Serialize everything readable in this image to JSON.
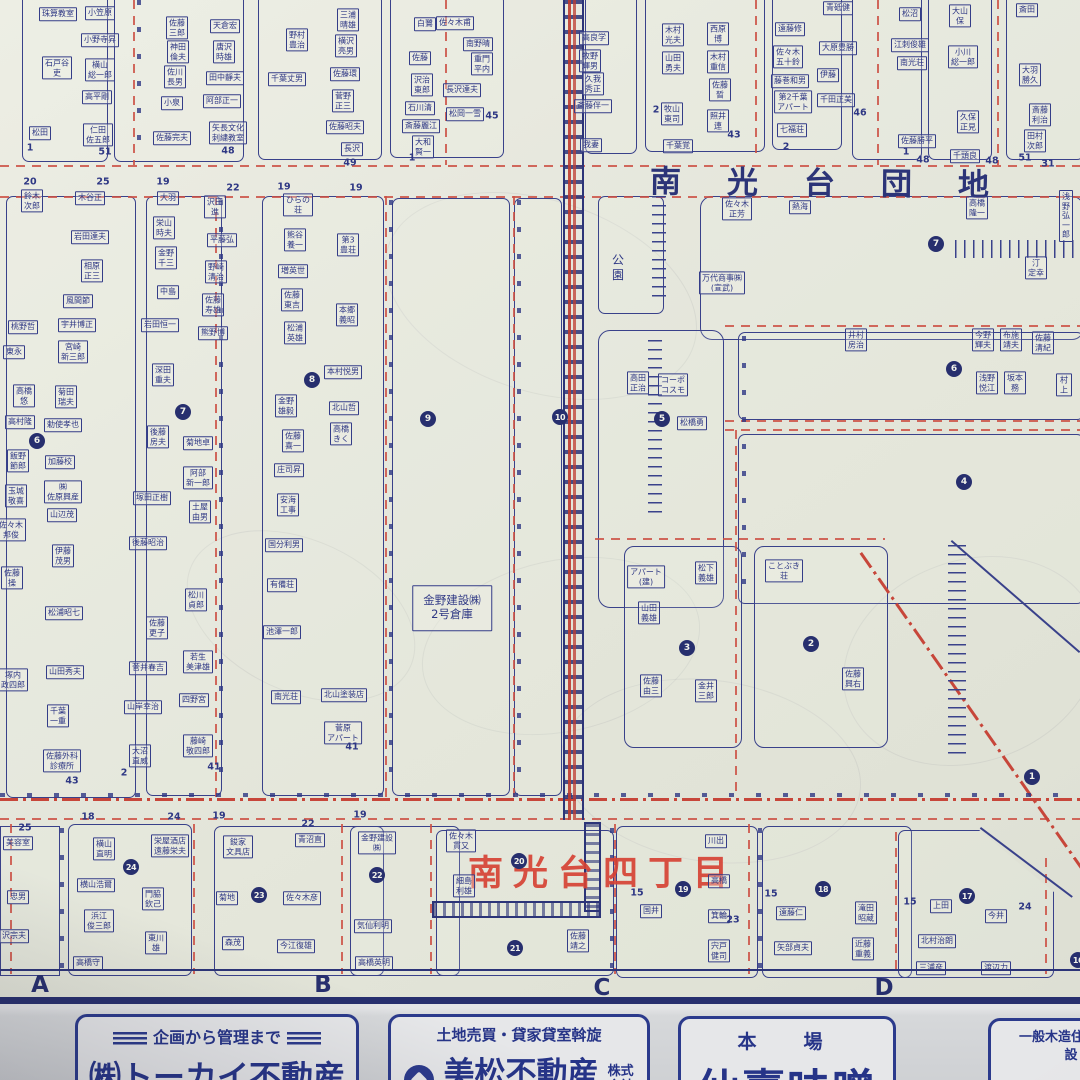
{
  "map": {
    "district_title": "南光台団地",
    "chome_label_red": "南光台四丁目",
    "warehouse_note": "金野建設㈱\n2号倉庫",
    "park_label": "公\n園",
    "grid_letters": [
      {
        "t": "A",
        "x": 40,
        "y": 985
      },
      {
        "t": "B",
        "x": 323,
        "y": 985
      },
      {
        "t": "C",
        "x": 602,
        "y": 988
      },
      {
        "t": "D",
        "x": 884,
        "y": 988
      }
    ],
    "circled_numbers": [
      {
        "n": "1",
        "x": 1032,
        "y": 777
      },
      {
        "n": "2",
        "x": 811,
        "y": 644
      },
      {
        "n": "3",
        "x": 687,
        "y": 648
      },
      {
        "n": "4",
        "x": 964,
        "y": 482
      },
      {
        "n": "5",
        "x": 662,
        "y": 419
      },
      {
        "n": "6",
        "x": 954,
        "y": 369
      },
      {
        "n": "6",
        "x": 37,
        "y": 441
      },
      {
        "n": "7",
        "x": 936,
        "y": 244
      },
      {
        "n": "7",
        "x": 183,
        "y": 412
      },
      {
        "n": "8",
        "x": 312,
        "y": 380
      },
      {
        "n": "9",
        "x": 428,
        "y": 419
      },
      {
        "n": "10",
        "x": 560,
        "y": 417
      },
      {
        "n": "16",
        "x": 1078,
        "y": 960
      },
      {
        "n": "17",
        "x": 967,
        "y": 896
      },
      {
        "n": "18",
        "x": 823,
        "y": 889
      },
      {
        "n": "19",
        "x": 683,
        "y": 889
      },
      {
        "n": "20",
        "x": 519,
        "y": 861
      },
      {
        "n": "21",
        "x": 515,
        "y": 948
      },
      {
        "n": "22",
        "x": 377,
        "y": 875
      },
      {
        "n": "23",
        "x": 259,
        "y": 895
      },
      {
        "n": "24",
        "x": 131,
        "y": 867
      }
    ],
    "lot_numbers": [
      {
        "t": "1",
        "x": 30,
        "y": 148
      },
      {
        "t": "51",
        "x": 105,
        "y": 152
      },
      {
        "t": "48",
        "x": 228,
        "y": 151
      },
      {
        "t": "49",
        "x": 350,
        "y": 163
      },
      {
        "t": "45",
        "x": 492,
        "y": 116
      },
      {
        "t": "1",
        "x": 412,
        "y": 158
      },
      {
        "t": "2",
        "x": 656,
        "y": 110
      },
      {
        "t": "43",
        "x": 734,
        "y": 135
      },
      {
        "t": "2",
        "x": 786,
        "y": 147
      },
      {
        "t": "46",
        "x": 860,
        "y": 113
      },
      {
        "t": "1",
        "x": 906,
        "y": 152
      },
      {
        "t": "48",
        "x": 992,
        "y": 161
      },
      {
        "t": "51",
        "x": 1025,
        "y": 158
      },
      {
        "t": "31",
        "x": 1048,
        "y": 164
      },
      {
        "t": "48",
        "x": 923,
        "y": 160
      },
      {
        "t": "20",
        "x": 30,
        "y": 182
      },
      {
        "t": "25",
        "x": 103,
        "y": 182
      },
      {
        "t": "19",
        "x": 163,
        "y": 182
      },
      {
        "t": "22",
        "x": 233,
        "y": 188
      },
      {
        "t": "19",
        "x": 284,
        "y": 187
      },
      {
        "t": "19",
        "x": 356,
        "y": 188
      },
      {
        "t": "41",
        "x": 214,
        "y": 767
      },
      {
        "t": "43",
        "x": 72,
        "y": 781
      },
      {
        "t": "2",
        "x": 124,
        "y": 773
      },
      {
        "t": "41",
        "x": 352,
        "y": 747
      },
      {
        "t": "25",
        "x": 25,
        "y": 828
      },
      {
        "t": "18",
        "x": 88,
        "y": 817
      },
      {
        "t": "24",
        "x": 174,
        "y": 817
      },
      {
        "t": "19",
        "x": 219,
        "y": 816
      },
      {
        "t": "22",
        "x": 308,
        "y": 824
      },
      {
        "t": "19",
        "x": 360,
        "y": 815
      },
      {
        "t": "15",
        "x": 637,
        "y": 893
      },
      {
        "t": "23",
        "x": 733,
        "y": 920
      },
      {
        "t": "15",
        "x": 771,
        "y": 894
      },
      {
        "t": "15",
        "x": 910,
        "y": 902
      },
      {
        "t": "24",
        "x": 1025,
        "y": 907
      }
    ],
    "houses": [
      {
        "t": "珠算教室",
        "x": 58,
        "y": 14
      },
      {
        "t": "小笠原",
        "x": 100,
        "y": 13
      },
      {
        "t": "小野寺昇",
        "x": 100,
        "y": 40
      },
      {
        "t": "石戸谷\n吏",
        "x": 57,
        "y": 68
      },
      {
        "t": "横山\n総一郎",
        "x": 100,
        "y": 70
      },
      {
        "t": "高平剛",
        "x": 97,
        "y": 97
      },
      {
        "t": "松田",
        "x": 40,
        "y": 133
      },
      {
        "t": "仁田\n佐五郎",
        "x": 98,
        "y": 135
      },
      {
        "t": "佐藤\n三郎",
        "x": 177,
        "y": 28
      },
      {
        "t": "神田\n倫夫",
        "x": 178,
        "y": 52
      },
      {
        "t": "佐川\n長男",
        "x": 175,
        "y": 77
      },
      {
        "t": "小泉",
        "x": 172,
        "y": 103
      },
      {
        "t": "佐藤完夫",
        "x": 172,
        "y": 138
      },
      {
        "t": "天倉宏",
        "x": 225,
        "y": 26
      },
      {
        "t": "唐沢\n時雄",
        "x": 224,
        "y": 52
      },
      {
        "t": "田中靜夫",
        "x": 225,
        "y": 78
      },
      {
        "t": "阿部正一",
        "x": 222,
        "y": 101
      },
      {
        "t": "矢長文化\n刺繍教室",
        "x": 228,
        "y": 133
      },
      {
        "t": "野村\n豊治",
        "x": 297,
        "y": 40
      },
      {
        "t": "千葉丈男",
        "x": 287,
        "y": 79
      },
      {
        "t": "三浦\n晴雄",
        "x": 348,
        "y": 20
      },
      {
        "t": "横沢\n亮男",
        "x": 346,
        "y": 46
      },
      {
        "t": "佐藤環",
        "x": 345,
        "y": 74
      },
      {
        "t": "菅野\n正三",
        "x": 343,
        "y": 101
      },
      {
        "t": "佐藤昭夫",
        "x": 345,
        "y": 127
      },
      {
        "t": "長沢",
        "x": 352,
        "y": 149
      },
      {
        "t": "白鷺",
        "x": 425,
        "y": 24
      },
      {
        "t": "佐藤",
        "x": 420,
        "y": 58
      },
      {
        "t": "沢治\n東郎",
        "x": 422,
        "y": 85
      },
      {
        "t": "石川清",
        "x": 420,
        "y": 108
      },
      {
        "t": "斎藤麗江",
        "x": 421,
        "y": 126
      },
      {
        "t": "大和\n賢一",
        "x": 423,
        "y": 147
      },
      {
        "t": "佐々木甫",
        "x": 455,
        "y": 23
      },
      {
        "t": "南野晴",
        "x": 478,
        "y": 44
      },
      {
        "t": "重門\n平内",
        "x": 482,
        "y": 64
      },
      {
        "t": "長沢達夫",
        "x": 462,
        "y": 90
      },
      {
        "t": "松岡一雪",
        "x": 465,
        "y": 114
      },
      {
        "t": "高良学",
        "x": 594,
        "y": 38
      },
      {
        "t": "牧野\n輝男",
        "x": 590,
        "y": 61
      },
      {
        "t": "久我\n秀正",
        "x": 593,
        "y": 84
      },
      {
        "t": "斎藤伴一",
        "x": 593,
        "y": 106
      },
      {
        "t": "我妻",
        "x": 591,
        "y": 145
      },
      {
        "t": "木村\n光夫",
        "x": 673,
        "y": 35
      },
      {
        "t": "山田\n勇夫",
        "x": 673,
        "y": 63
      },
      {
        "t": "西原\n博",
        "x": 718,
        "y": 34
      },
      {
        "t": "木村\n重信",
        "x": 718,
        "y": 62
      },
      {
        "t": "佐藤\n晳",
        "x": 720,
        "y": 90
      },
      {
        "t": "牧山\n東司",
        "x": 672,
        "y": 114
      },
      {
        "t": "照井\n連",
        "x": 718,
        "y": 121
      },
      {
        "t": "千葉覚",
        "x": 678,
        "y": 146
      },
      {
        "t": "遠藤修",
        "x": 790,
        "y": 29
      },
      {
        "t": "佐々木\n五十鈴",
        "x": 788,
        "y": 57
      },
      {
        "t": "藤巻和男",
        "x": 790,
        "y": 81
      },
      {
        "t": "第2千葉\nアパート",
        "x": 793,
        "y": 102
      },
      {
        "t": "七福荘",
        "x": 792,
        "y": 130
      },
      {
        "t": "青砥健",
        "x": 838,
        "y": 8
      },
      {
        "t": "大原豊勝",
        "x": 838,
        "y": 48
      },
      {
        "t": "伊藤",
        "x": 828,
        "y": 75
      },
      {
        "t": "千田正美",
        "x": 836,
        "y": 100
      },
      {
        "t": "松沼",
        "x": 910,
        "y": 14
      },
      {
        "t": "江刺俊雄",
        "x": 910,
        "y": 45
      },
      {
        "t": "南光荘",
        "x": 912,
        "y": 63
      },
      {
        "t": "佐藤勝平",
        "x": 917,
        "y": 141
      },
      {
        "t": "大山\n保",
        "x": 960,
        "y": 16
      },
      {
        "t": "小川\n総一郎",
        "x": 963,
        "y": 57
      },
      {
        "t": "久保\n正見",
        "x": 968,
        "y": 122
      },
      {
        "t": "千頭良",
        "x": 965,
        "y": 156
      },
      {
        "t": "斎田",
        "x": 1027,
        "y": 10
      },
      {
        "t": "大羽\n勝久",
        "x": 1030,
        "y": 75
      },
      {
        "t": "斎藤\n利治",
        "x": 1040,
        "y": 115
      },
      {
        "t": "田村\n次郎",
        "x": 1035,
        "y": 141
      },
      {
        "t": "鈴木\n次郎",
        "x": 32,
        "y": 201
      },
      {
        "t": "木谷正",
        "x": 90,
        "y": 198
      },
      {
        "t": "岩田達夫",
        "x": 90,
        "y": 237
      },
      {
        "t": "相原\n正三",
        "x": 92,
        "y": 271
      },
      {
        "t": "風間節",
        "x": 78,
        "y": 301
      },
      {
        "t": "宇井博正",
        "x": 77,
        "y": 325
      },
      {
        "t": "宮崎\n新三郎",
        "x": 73,
        "y": 352
      },
      {
        "t": "桃野哲",
        "x": 23,
        "y": 327
      },
      {
        "t": "東永",
        "x": 14,
        "y": 352
      },
      {
        "t": "高橋\n悠",
        "x": 24,
        "y": 396
      },
      {
        "t": "高村隆",
        "x": 20,
        "y": 422
      },
      {
        "t": "菊田\n瑞夫",
        "x": 66,
        "y": 397
      },
      {
        "t": "勅使孝也",
        "x": 63,
        "y": 425
      },
      {
        "t": "飯野\n節郎",
        "x": 18,
        "y": 461
      },
      {
        "t": "加藤校",
        "x": 60,
        "y": 462
      },
      {
        "t": "玉城\n敬喜",
        "x": 16,
        "y": 496
      },
      {
        "t": "㈱\n佐原興産",
        "x": 63,
        "y": 492
      },
      {
        "t": "大羽",
        "x": 168,
        "y": 198
      },
      {
        "t": "栄山\n時夫",
        "x": 164,
        "y": 228
      },
      {
        "t": "金野\n千三",
        "x": 166,
        "y": 258
      },
      {
        "t": "中島",
        "x": 168,
        "y": 292
      },
      {
        "t": "岩田恒一",
        "x": 160,
        "y": 325
      },
      {
        "t": "深田\n重夫",
        "x": 163,
        "y": 375
      },
      {
        "t": "後藤\n房夫",
        "x": 158,
        "y": 437
      },
      {
        "t": "塚田正樹",
        "x": 152,
        "y": 498
      },
      {
        "t": "山辺茂",
        "x": 62,
        "y": 515
      },
      {
        "t": "佐々木\n邦俊",
        "x": 11,
        "y": 530
      },
      {
        "t": "伊藤\n茂男",
        "x": 63,
        "y": 556
      },
      {
        "t": "佐藤\n操",
        "x": 12,
        "y": 578
      },
      {
        "t": "松浦昭七",
        "x": 64,
        "y": 613
      },
      {
        "t": "塚内\n政四郎",
        "x": 13,
        "y": 680
      },
      {
        "t": "山田秀夫",
        "x": 65,
        "y": 672
      },
      {
        "t": "千葉\n一重",
        "x": 58,
        "y": 716
      },
      {
        "t": "佐藤外科\n診療所",
        "x": 62,
        "y": 761
      },
      {
        "t": "後藤昭治",
        "x": 148,
        "y": 543
      },
      {
        "t": "佐藤\n更子",
        "x": 157,
        "y": 628
      },
      {
        "t": "菅井春吉",
        "x": 148,
        "y": 668
      },
      {
        "t": "山岸幸治",
        "x": 143,
        "y": 707
      },
      {
        "t": "大沼\n直威",
        "x": 140,
        "y": 756
      },
      {
        "t": "松川\n貞郎",
        "x": 196,
        "y": 600
      },
      {
        "t": "若生\n美津雄",
        "x": 198,
        "y": 662
      },
      {
        "t": "四野宮",
        "x": 194,
        "y": 700
      },
      {
        "t": "藤崎\n敬四郎",
        "x": 198,
        "y": 746
      },
      {
        "t": "沢田\n進",
        "x": 215,
        "y": 207
      },
      {
        "t": "平藤弘",
        "x": 222,
        "y": 240
      },
      {
        "t": "野崎\n清治",
        "x": 216,
        "y": 272
      },
      {
        "t": "佐藤\n寿雄",
        "x": 213,
        "y": 305
      },
      {
        "t": "熊野博",
        "x": 213,
        "y": 333
      },
      {
        "t": "菊地卓",
        "x": 198,
        "y": 443
      },
      {
        "t": "阿部\n新一郎",
        "x": 198,
        "y": 478
      },
      {
        "t": "土屋\n由男",
        "x": 200,
        "y": 512
      },
      {
        "t": "ひらの\n荘",
        "x": 298,
        "y": 205
      },
      {
        "t": "熊谷\n養一",
        "x": 295,
        "y": 240
      },
      {
        "t": "増英世",
        "x": 293,
        "y": 271
      },
      {
        "t": "佐藤\n東吉",
        "x": 292,
        "y": 300
      },
      {
        "t": "松浦\n英雄",
        "x": 295,
        "y": 333
      },
      {
        "t": "金野\n雄毅",
        "x": 286,
        "y": 406
      },
      {
        "t": "佐藤\n喜一",
        "x": 293,
        "y": 441
      },
      {
        "t": "庄司昇",
        "x": 289,
        "y": 470
      },
      {
        "t": "安海\n工事",
        "x": 288,
        "y": 505
      },
      {
        "t": "国分利男",
        "x": 284,
        "y": 545
      },
      {
        "t": "有備荘",
        "x": 282,
        "y": 585
      },
      {
        "t": "池澤一郎",
        "x": 282,
        "y": 632
      },
      {
        "t": "南光荘",
        "x": 286,
        "y": 697
      },
      {
        "t": "第3\n豊荘",
        "x": 348,
        "y": 245
      },
      {
        "t": "本郷\n義昭",
        "x": 347,
        "y": 315
      },
      {
        "t": "本村悦男",
        "x": 343,
        "y": 372
      },
      {
        "t": "北山哲",
        "x": 344,
        "y": 408
      },
      {
        "t": "高橋\nきく",
        "x": 341,
        "y": 434
      },
      {
        "t": "北山塗装店",
        "x": 344,
        "y": 695
      },
      {
        "t": "菅原\nアパート",
        "x": 343,
        "y": 733
      },
      {
        "t": "高田\n正治",
        "x": 638,
        "y": 383
      },
      {
        "t": "コーポ\nコスモ",
        "x": 673,
        "y": 385
      },
      {
        "t": "松橋勇",
        "x": 692,
        "y": 423
      },
      {
        "t": "佐々木\n正芳",
        "x": 737,
        "y": 209
      },
      {
        "t": "熱海",
        "x": 800,
        "y": 207
      },
      {
        "t": "万代商事㈱\n(宣武)",
        "x": 722,
        "y": 283
      },
      {
        "t": "高橋\n隆一",
        "x": 977,
        "y": 208
      },
      {
        "t": "浅野\n弘一郎",
        "x": 1066,
        "y": 216
      },
      {
        "t": "汀\n定幸",
        "x": 1036,
        "y": 268
      },
      {
        "t": "井村\n房治",
        "x": 856,
        "y": 340
      },
      {
        "t": "今野\n輝夫",
        "x": 983,
        "y": 340
      },
      {
        "t": "布施\n靖夫",
        "x": 1011,
        "y": 340
      },
      {
        "t": "佐藤\n清紀",
        "x": 1043,
        "y": 343
      },
      {
        "t": "浅野\n悦江",
        "x": 987,
        "y": 383
      },
      {
        "t": "坂本\n務",
        "x": 1015,
        "y": 383
      },
      {
        "t": "村上",
        "x": 1064,
        "y": 385
      },
      {
        "t": "アパート\n(建)",
        "x": 646,
        "y": 577
      },
      {
        "t": "松下\n義雄",
        "x": 706,
        "y": 573
      },
      {
        "t": "山田\n義雄",
        "x": 649,
        "y": 613
      },
      {
        "t": "佐藤\n由三",
        "x": 651,
        "y": 686
      },
      {
        "t": "金井\n三郎",
        "x": 706,
        "y": 691
      },
      {
        "t": "ことぶき\n荘",
        "x": 784,
        "y": 571
      },
      {
        "t": "佐藤\n興右",
        "x": 853,
        "y": 679
      },
      {
        "t": "美容室",
        "x": 18,
        "y": 843
      },
      {
        "t": "忠男",
        "x": 18,
        "y": 897
      },
      {
        "t": "沢宗夫",
        "x": 14,
        "y": 936
      },
      {
        "t": "横山\n直明",
        "x": 104,
        "y": 849
      },
      {
        "t": "栄屋酒店\n遠藤栄夫",
        "x": 170,
        "y": 846
      },
      {
        "t": "横山浩爾",
        "x": 96,
        "y": 885
      },
      {
        "t": "門脇\n欽己",
        "x": 153,
        "y": 899
      },
      {
        "t": "浜江\n俊三郎",
        "x": 99,
        "y": 921
      },
      {
        "t": "東川\n雄",
        "x": 156,
        "y": 943
      },
      {
        "t": "高橋守",
        "x": 88,
        "y": 963
      },
      {
        "t": "鋑家\n文具店",
        "x": 238,
        "y": 847
      },
      {
        "t": "青沼直",
        "x": 310,
        "y": 840
      },
      {
        "t": "菊地",
        "x": 227,
        "y": 898
      },
      {
        "t": "佐々木彦",
        "x": 302,
        "y": 898
      },
      {
        "t": "森茂",
        "x": 233,
        "y": 943
      },
      {
        "t": "今江復雄",
        "x": 296,
        "y": 946
      },
      {
        "t": "金野建設\n㈱",
        "x": 377,
        "y": 843
      },
      {
        "t": "気仙利明",
        "x": 373,
        "y": 926
      },
      {
        "t": "高橋英明",
        "x": 374,
        "y": 963
      },
      {
        "t": "佐々木\n貫又",
        "x": 461,
        "y": 841
      },
      {
        "t": "細島\n利雄",
        "x": 464,
        "y": 886
      },
      {
        "t": "佐藤\n靖之",
        "x": 578,
        "y": 941
      },
      {
        "t": "国井",
        "x": 651,
        "y": 911
      },
      {
        "t": "川出",
        "x": 716,
        "y": 841
      },
      {
        "t": "高橋",
        "x": 719,
        "y": 881
      },
      {
        "t": "箕輪",
        "x": 719,
        "y": 916
      },
      {
        "t": "宍戸\n健司",
        "x": 719,
        "y": 951
      },
      {
        "t": "遠藤仁",
        "x": 791,
        "y": 913
      },
      {
        "t": "矢部貞夫",
        "x": 793,
        "y": 948
      },
      {
        "t": "滝田\n昭蔵",
        "x": 866,
        "y": 913
      },
      {
        "t": "近藤\n重義",
        "x": 863,
        "y": 949
      },
      {
        "t": "上田",
        "x": 941,
        "y": 906
      },
      {
        "t": "今井",
        "x": 996,
        "y": 916
      },
      {
        "t": "北村治朗",
        "x": 937,
        "y": 941
      },
      {
        "t": "三浦彦",
        "x": 931,
        "y": 968
      },
      {
        "t": "渡辺力",
        "x": 996,
        "y": 968
      }
    ]
  },
  "ads": {
    "tokai": {
      "tagline": "企画から管理まで",
      "name": "㈱トーカイ不動産"
    },
    "mimatsu": {
      "tagline": "土地売買・貸家貸室斡旋",
      "name": "美松不動産",
      "suffix": "株式\n会社"
    },
    "miso": {
      "top": "本　場",
      "name": "仙臺味噌"
    },
    "mokuzo": {
      "line": "一般木造住宅・建\n設"
    }
  }
}
